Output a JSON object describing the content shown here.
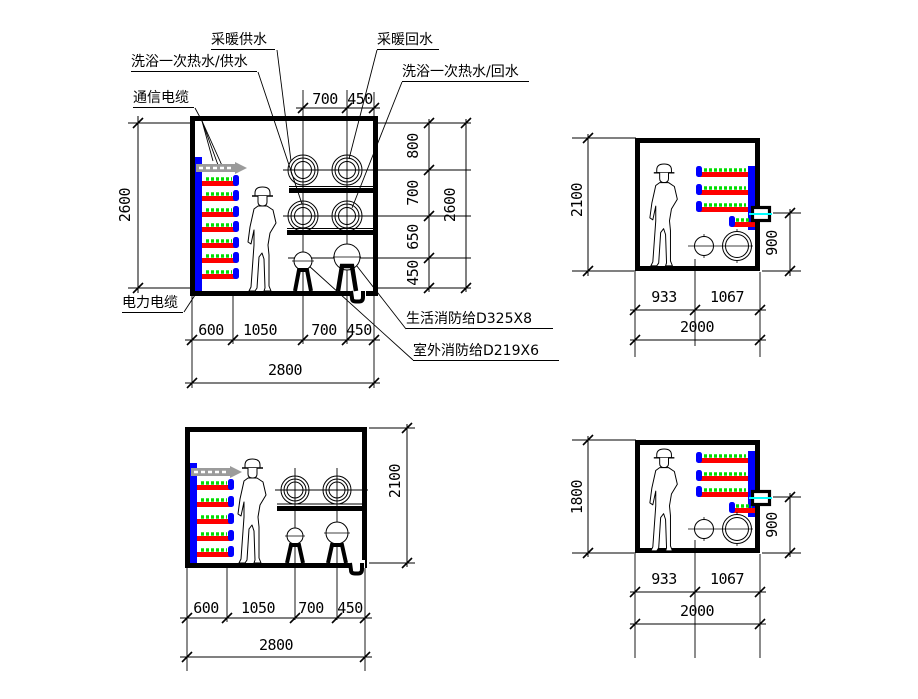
{
  "labels": {
    "heating_supply": "采暖供水",
    "heating_return": "采暖回水",
    "bath_hot_water_supply": "洗浴一次热水/供水",
    "bath_hot_water_return": "洗浴一次热水/回水",
    "communication_cable": "通信电缆",
    "power_cable": "电力电缆",
    "domestic_fire_main": "生活消防给D325X8",
    "outdoor_fire_main": "室外消防给D219X6"
  },
  "sections": {
    "a": {
      "description": "large trench section 2800 x 2600",
      "top": [
        "700",
        "450"
      ],
      "right": [
        "800",
        "700",
        "650",
        "450"
      ],
      "right_total": "2600",
      "left_total": "2600",
      "bottom": [
        "600",
        "1050",
        "700",
        "450"
      ],
      "bottom_total": "2800"
    },
    "b": {
      "description": "small trench section 2000 x 2100",
      "left_total": "2100",
      "right": "900",
      "bottom": [
        "933",
        "1067"
      ],
      "bottom_total": "2000"
    },
    "c": {
      "description": "large trench section 2800 x 2100",
      "right_total": "2100",
      "bottom": [
        "600",
        "1050",
        "700",
        "450"
      ],
      "bottom_total": "2800"
    },
    "d": {
      "description": "small trench section 2000 x 1800",
      "left_total": "1800",
      "right": "900",
      "bottom": [
        "933",
        "1067"
      ],
      "bottom_total": "2000"
    }
  },
  "colors": {
    "cable_tray_blue": "#0000ff",
    "bracket_red": "#ff0000",
    "cable_green": "#00dd00",
    "comm_arrow_gray": "#9b9b9b",
    "conduit_cyan": "#00ffff",
    "line_black": "#000000"
  }
}
